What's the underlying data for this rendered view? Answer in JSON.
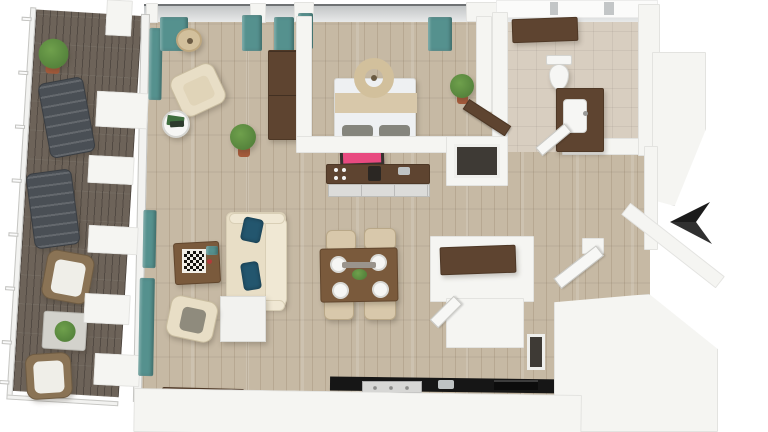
{
  "scene": {
    "type": "3d-top-down-floor-plan-render",
    "compass_arrow": {
      "name": "entry-arrow-marker",
      "direction": "left",
      "color": "#1b1b1b"
    },
    "flooring": {
      "interior": "light-oak-plank",
      "balcony": "dark-composite-deck",
      "bathroom": "beige-tile"
    },
    "rooms": [
      {
        "id": "balcony",
        "items": [
          "potted-plant",
          "sun-lounger",
          "sun-lounger",
          "wicker-armchair",
          "plant-side-table",
          "wicker-armchair",
          "glass-railing"
        ]
      },
      {
        "id": "living-room",
        "items": [
          "drum-floor-lamp",
          "swivel-armchair",
          "round-side-table",
          "green-books",
          "potted-plant",
          "sofa",
          "navy-throw-pillows",
          "coffee-table",
          "chess-board",
          "armchair",
          "cube-side-table",
          "media-console",
          "teal-curtains"
        ]
      },
      {
        "id": "bedroom",
        "items": [
          "double-bed",
          "ring-pendant-lamp",
          "gray-pillows",
          "tall-cabinet",
          "potted-plant",
          "dark-wood-door",
          "teal-curtains"
        ]
      },
      {
        "id": "bathroom",
        "items": [
          "toilet",
          "vanity-with-sink",
          "storage-cabinet",
          "white-door"
        ]
      },
      {
        "id": "kitchen",
        "items": [
          "pink-wall-art",
          "dark-counter-desk",
          "drawer-unit",
          "black-cooktop-counter",
          "range",
          "coffee-maker"
        ]
      },
      {
        "id": "dining-area",
        "items": [
          "dining-table",
          "dining-chair",
          "dining-chair",
          "dining-chair",
          "dining-chair",
          "place-settings",
          "green-bowl"
        ]
      },
      {
        "id": "laundry-closet",
        "items": [
          "brown-counter",
          "closet-door",
          "stacked-appliance-niche"
        ]
      },
      {
        "id": "entry-hall",
        "items": [
          "entry-door",
          "entry-arrow-marker",
          "wall-niche"
        ]
      }
    ],
    "palette": {
      "background": "#ffffff",
      "wall": "#f5f5f2",
      "wall_edge": "#d9d8d3",
      "roof_white": "#fbfbfa",
      "glass_gray": "#c3c6c7",
      "glass_dark": "#6f7274",
      "floor_wood": "#c6b9a4",
      "floor_grain": "#7a644a",
      "deck_wood": "#6d6359",
      "bath_tile": "#d8cec0",
      "curtain_teal": "#55918e",
      "railing_white": "#f2f2f0",
      "lounger_gray": "#4a4f55",
      "wicker_brown": "#8a7355",
      "cushion_white": "#efeee8",
      "sofa_cream": "#e8dec6",
      "sofa_edge": "#d9cfb6",
      "pillow_navy": "#23566e",
      "chair_beige": "#d8c8ab",
      "cushion_gray": "#8f8b7d",
      "wood_brown": "#7a5a3c",
      "dark_brown": "#5e4430",
      "darker_brown": "#4e3826",
      "bed_white": "#eef0f2",
      "bed_band": "#d8c8aa",
      "pillow_gray": "#85857d",
      "pendant_beige": "#d2c09c",
      "artwork_pink": "#e84a80",
      "art_frame": "#35322e",
      "counter_black": "#161616",
      "stove_gray": "#d7d7d5",
      "steel_gray": "#bfc3c4",
      "drawer_gray": "#dcdcda",
      "plant_green": "#55833c",
      "plant_light": "#6fa04c",
      "pot_terracotta": "#a65b3b",
      "porcelain": "#f6f6f4",
      "niche_dark": "#3e3a35",
      "arrow_black": "#1b1b1b",
      "arrow_facet": "#303030",
      "door_white": "#f7f7f5",
      "tray_gray": "#9a948c",
      "basket_tan": "#cbb289",
      "checker_dark": "#15130f",
      "checker_light": "#f2efe8"
    }
  }
}
